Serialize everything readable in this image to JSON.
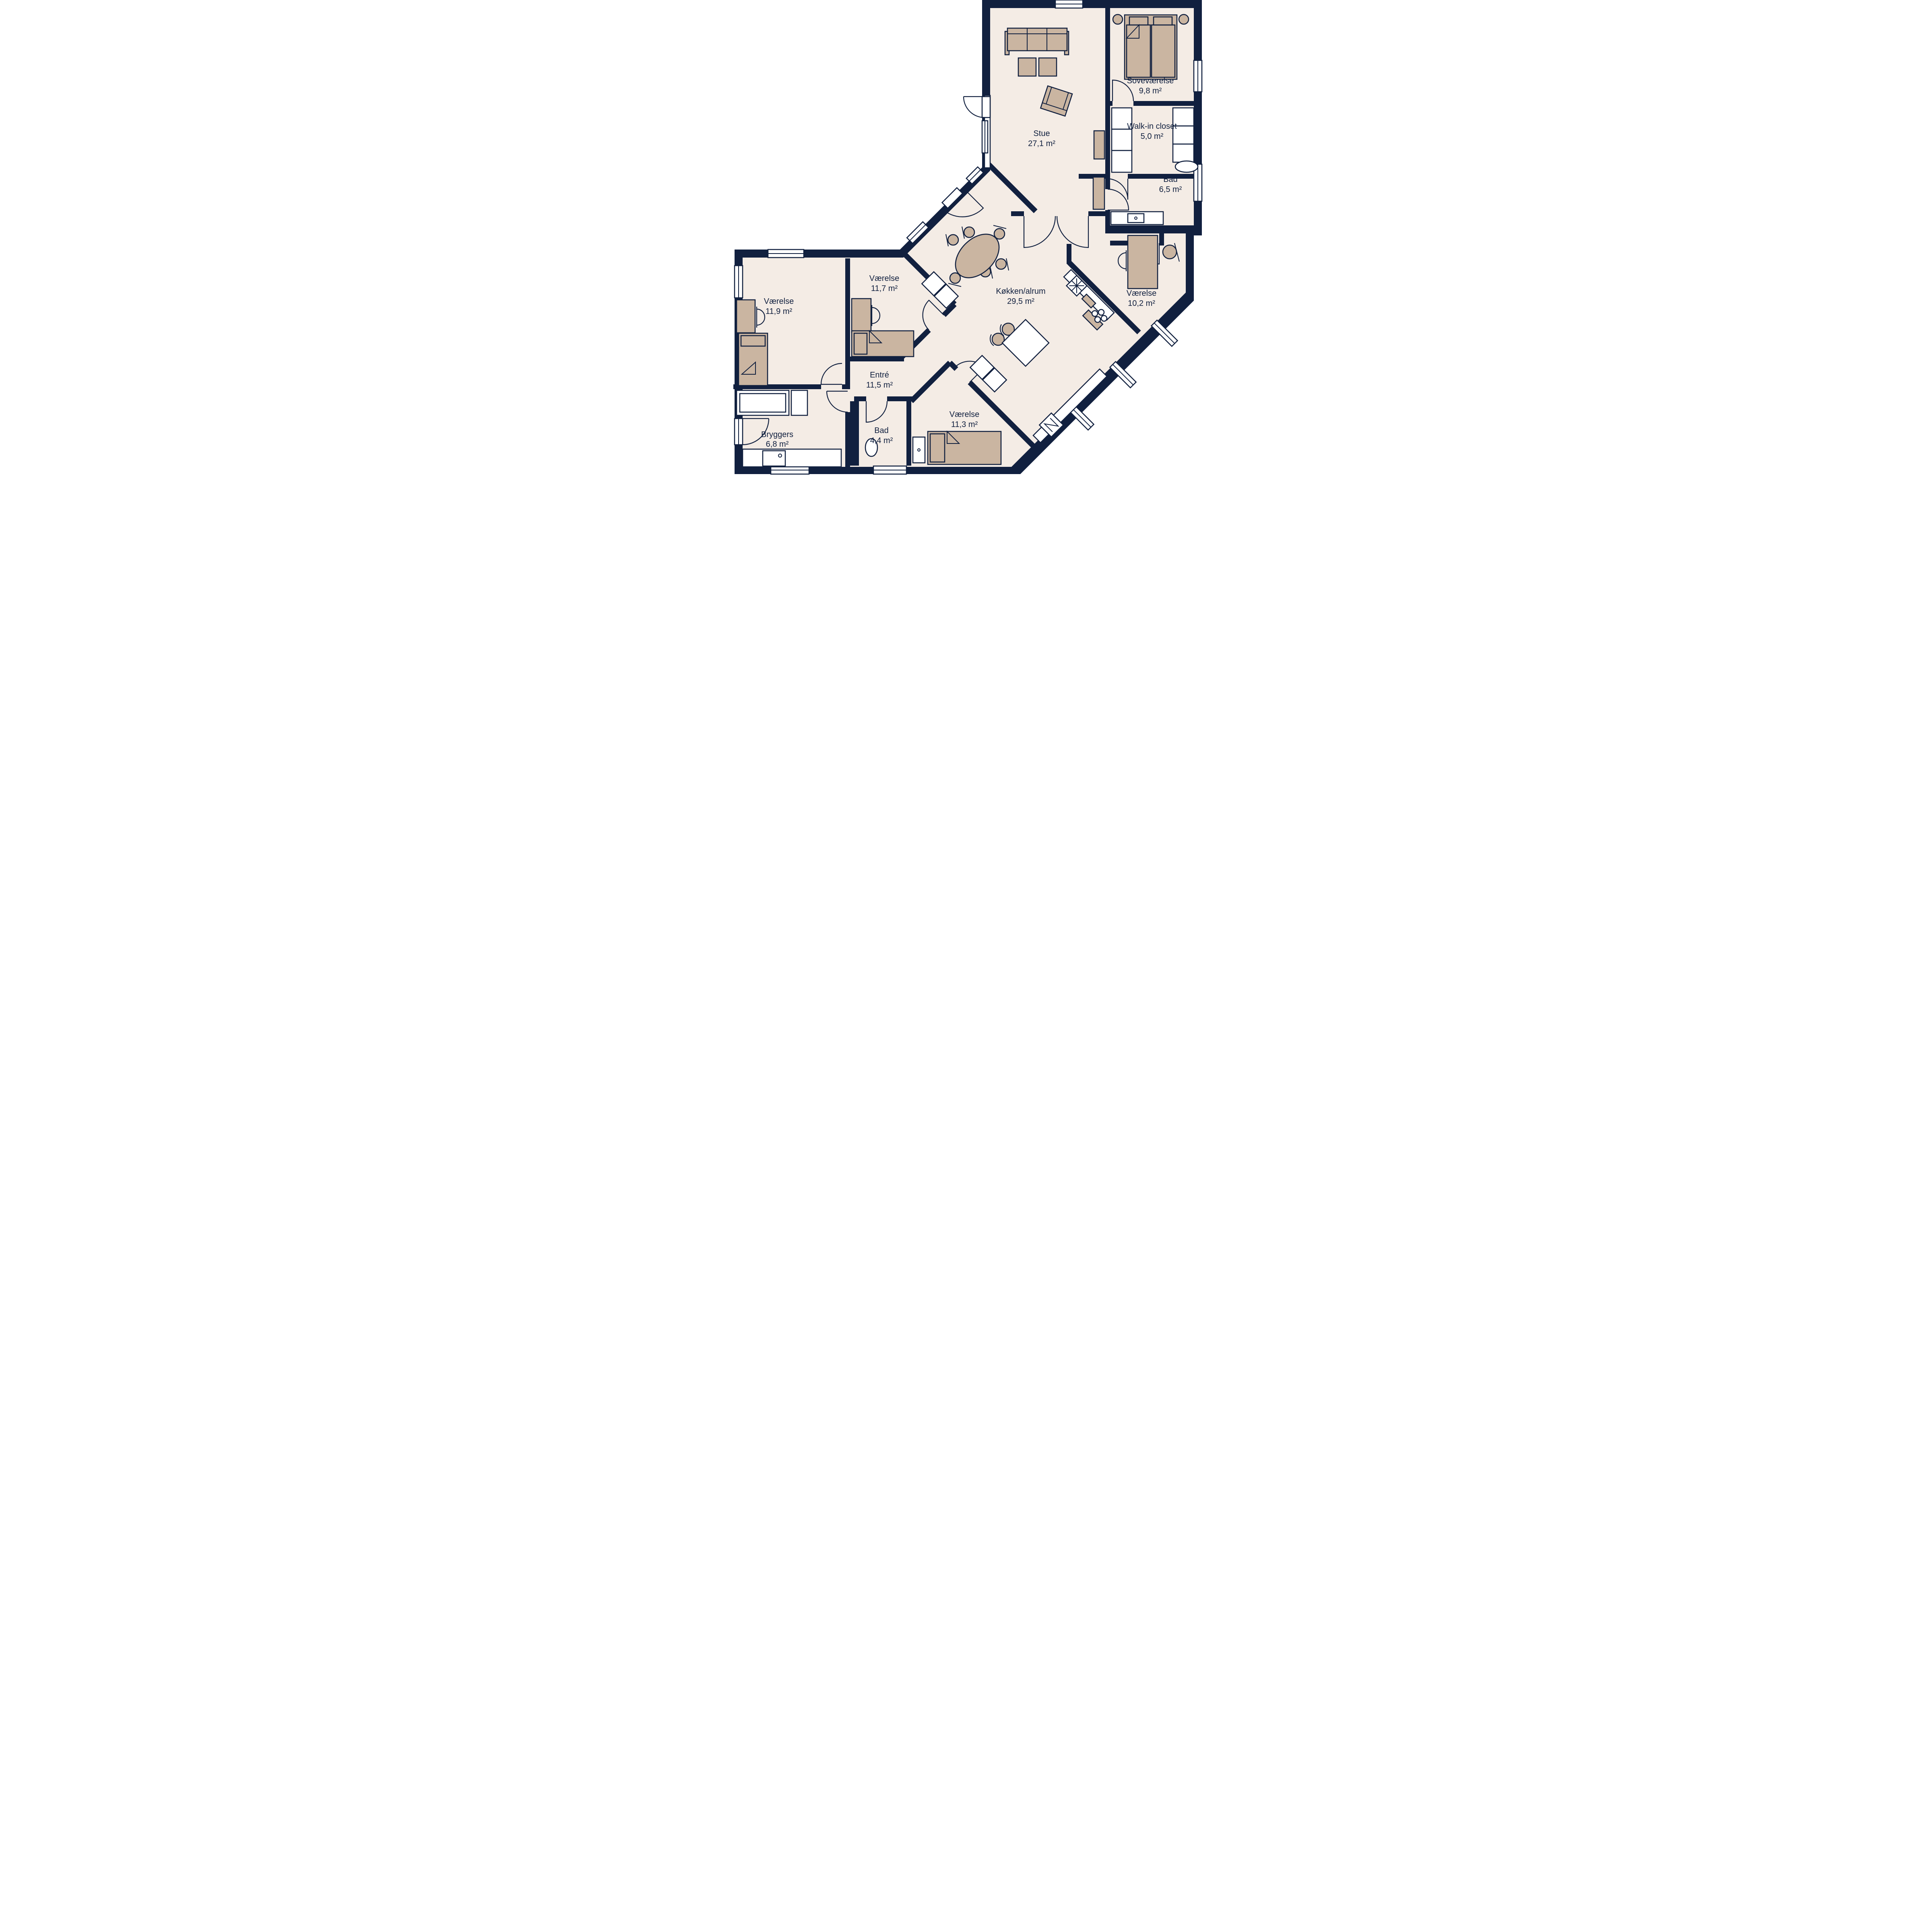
{
  "plan": {
    "colors": {
      "wall": "#11203f",
      "floor": "#f4ece5",
      "furniture": "#cab5a1",
      "white": "#ffffff"
    },
    "rooms": [
      {
        "name": "Stue",
        "area": "27,1 m²"
      },
      {
        "name": "Soveværelse",
        "area": "9,8 m²"
      },
      {
        "name": "Walk-in closet",
        "area": "5,0 m²"
      },
      {
        "name": "Bad",
        "area": "6,5 m²"
      },
      {
        "name": "Værelse",
        "area": "10,2 m²"
      },
      {
        "name": "Køkken/alrum",
        "area": "29,5 m²"
      },
      {
        "name": "Værelse",
        "area": "11,9 m²"
      },
      {
        "name": "Værelse",
        "area": "11,7 m²"
      },
      {
        "name": "Entré",
        "area": "11,5 m²"
      },
      {
        "name": "Værelse",
        "area": "11,3 m²"
      },
      {
        "name": "Bad",
        "area": "4,4 m²"
      },
      {
        "name": "Bryggers",
        "area": "6,8 m²"
      }
    ]
  }
}
